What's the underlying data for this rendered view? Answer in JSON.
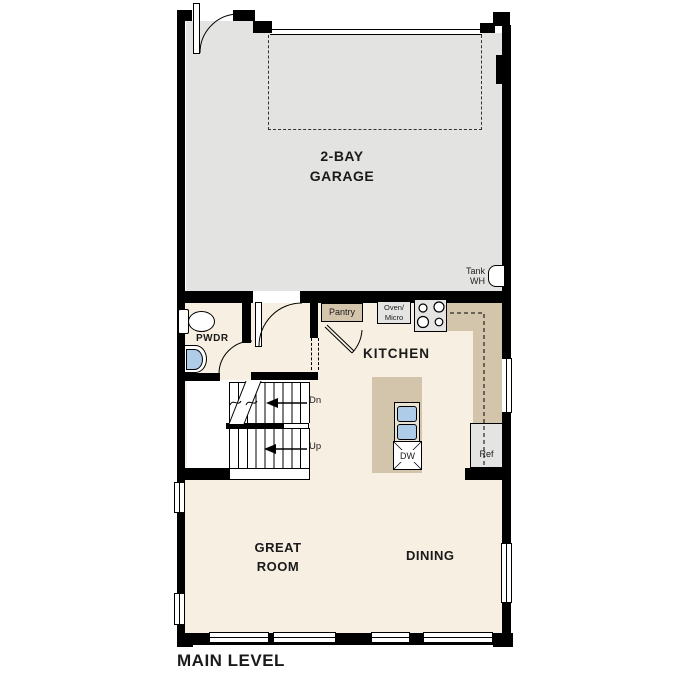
{
  "title": "MAIN LEVEL",
  "colors": {
    "wall": "#000000",
    "garage_floor": "#e3e3e1",
    "living_floor": "#f7efe2",
    "counter": "#d2c5ab",
    "appliance": "#e4e4e2",
    "fixture_blue": "#aecbe8",
    "text": "#1a1a1a"
  },
  "rooms": {
    "garage": {
      "line1": "2-BAY",
      "line2": "GARAGE"
    },
    "kitchen": {
      "label": "KITCHEN"
    },
    "great_room": {
      "line1": "GREAT",
      "line2": "ROOM"
    },
    "dining": {
      "label": "DINING"
    },
    "powder": {
      "label": "PWDR"
    }
  },
  "fixtures": {
    "tank_wh": {
      "line1": "Tank",
      "line2": "WH"
    },
    "pantry": {
      "label": "Pantry"
    },
    "oven_micro": {
      "line1": "Oven/",
      "line2": "Micro"
    },
    "dishwasher": {
      "label": "DW"
    },
    "refrigerator": {
      "label": "Ref"
    }
  },
  "stairs": {
    "down_label": "Dn",
    "up_label": "Up"
  }
}
